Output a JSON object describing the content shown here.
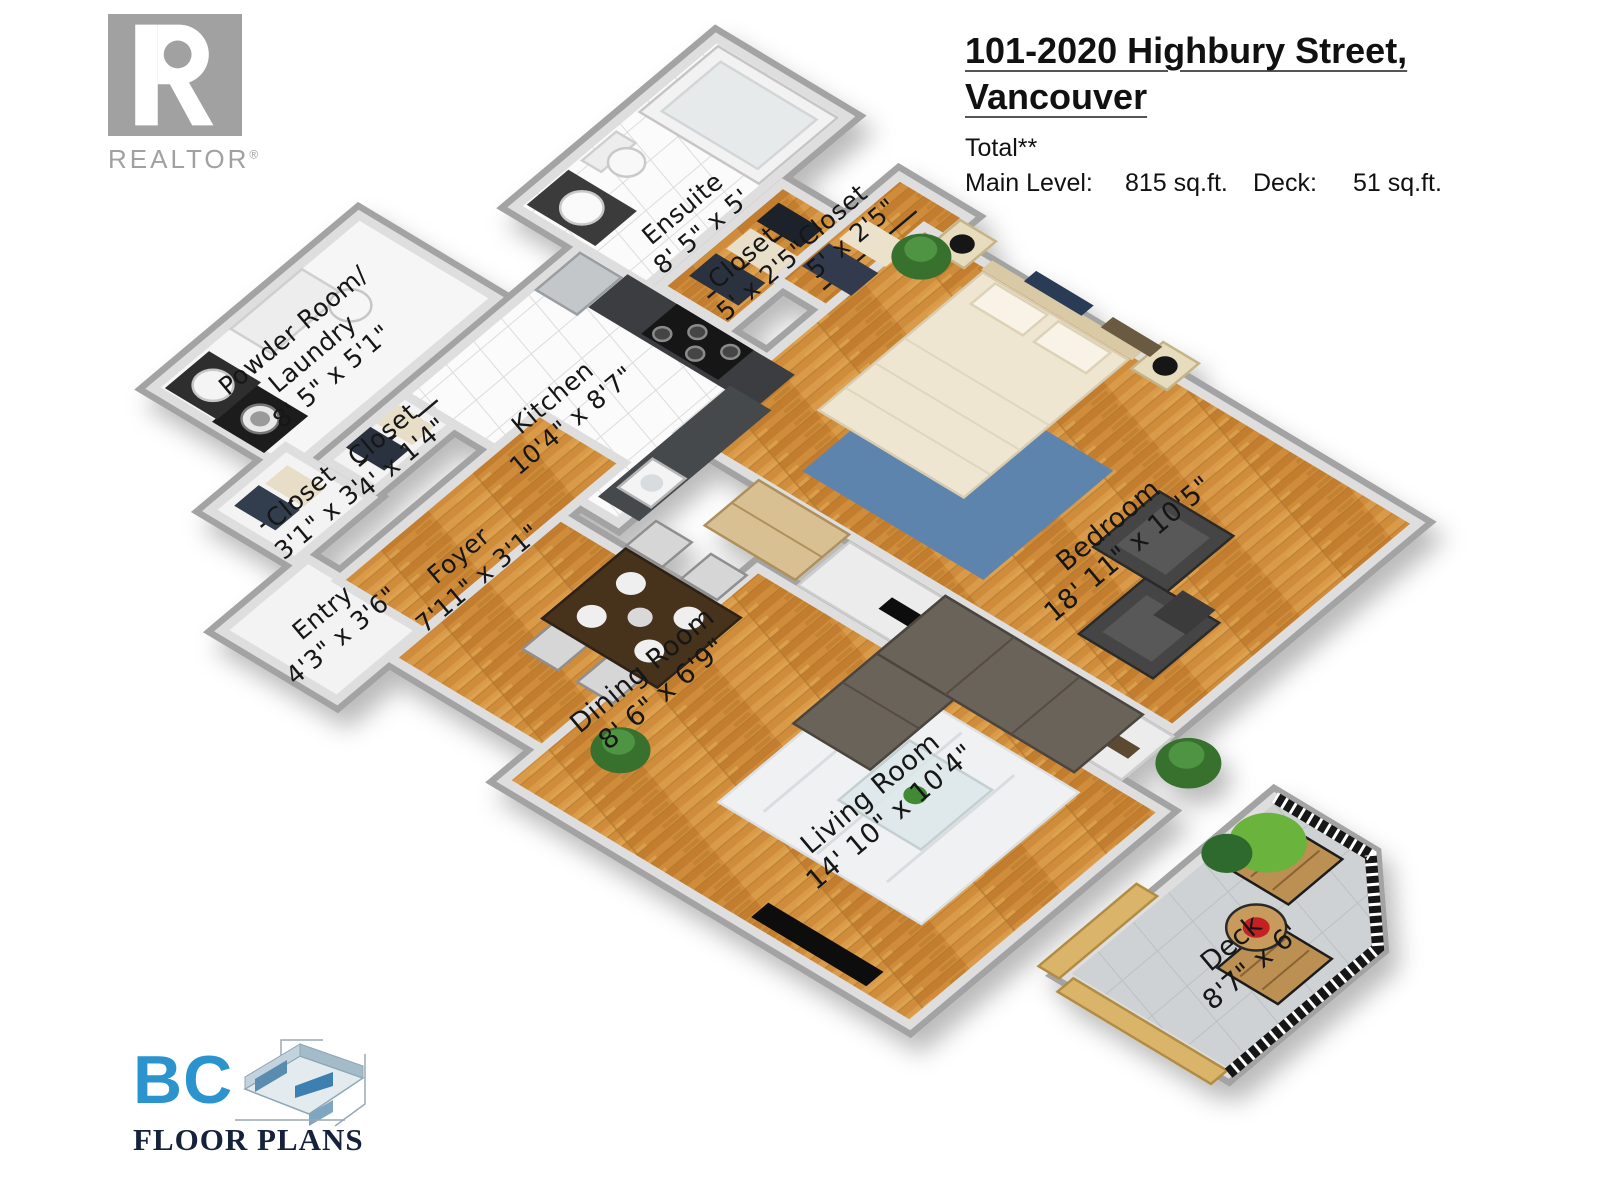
{
  "header": {
    "title_line1": "101-2020 Highbury Street,",
    "title_line2": "Vancouver",
    "total_label": "Total**",
    "main_level_label": "Main Level:",
    "main_level_value": "815 sq.ft.",
    "deck_label": "Deck:",
    "deck_value": "51 sq.ft."
  },
  "branding": {
    "realtor_text": "REALTOR",
    "realtor_reg_mark": "®",
    "bc_text": "BC",
    "bc_subtext": "FLOOR PLANS"
  },
  "floor_plan": {
    "rooms": [
      {
        "name": "Ensuite",
        "dims": "8' 5\" x 5'"
      },
      {
        "name": "Closet",
        "dims": "5' x 2'5\""
      },
      {
        "name": "Closet",
        "dims": "5' x 2'5\""
      },
      {
        "name": "Powder Room/",
        "name2": "Laundry",
        "dims": "8' 5\" x 5'1\""
      },
      {
        "name": "Kitchen",
        "dims": "10'4\" x 8'7\""
      },
      {
        "name": "Closet",
        "dims": "4' x 1'4\""
      },
      {
        "name": "Closet",
        "dims": "3'1\" x 3'"
      },
      {
        "name": "Entry",
        "dims": "4'3\" x 3'6\""
      },
      {
        "name": "Foyer",
        "dims": "7'11\" x 3'1\""
      },
      {
        "name": "Dining Room",
        "dims": "8' 6\" x 6'9\""
      },
      {
        "name": "Bedroom",
        "dims": "18' 11\" x 10'5\""
      },
      {
        "name": "Living Room",
        "dims": "14' 10\" x 10'4\""
      },
      {
        "name": "Deck",
        "dims": "8'7\" x 6'"
      }
    ]
  },
  "colors": {
    "wood_floor": "#cf8c3a",
    "wall_grey": "#d6d6d6",
    "outer_wall_grey": "#a3a3a3",
    "deck_tile": "#cfd2d4",
    "rug_blue": "#5d84ad",
    "bc_logo_blue": "#2b93ce",
    "realtor_grey": "#a1a1a1",
    "railing_black": "#191919"
  }
}
